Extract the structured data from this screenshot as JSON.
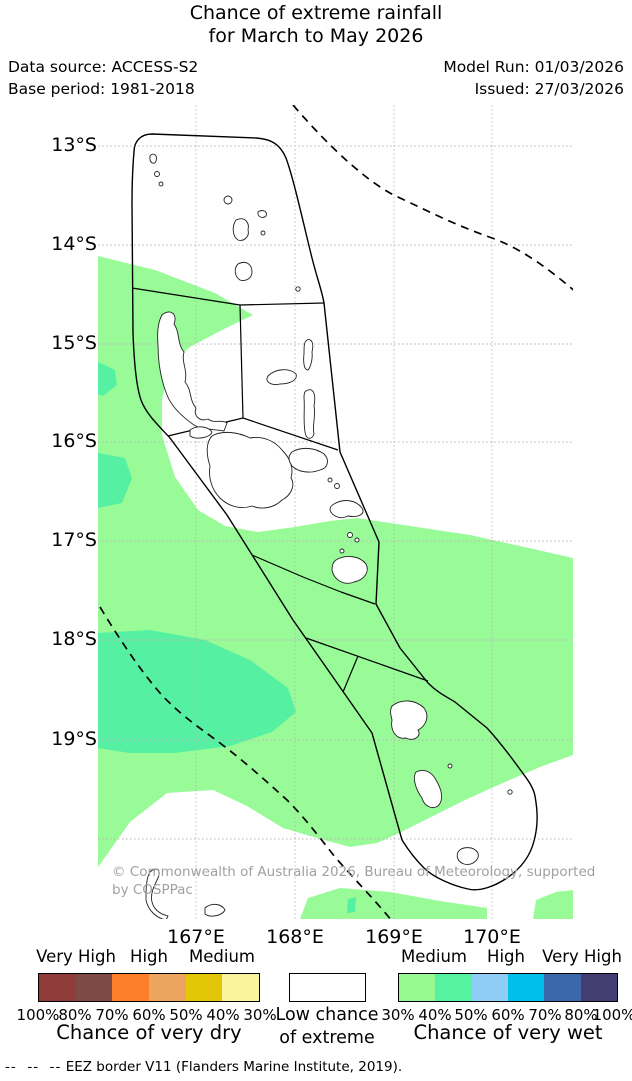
{
  "header": {
    "title_line1": "Chance of extreme rainfall",
    "title_line2": "for March to May 2026",
    "data_source": "Data source: ACCESS-S2",
    "base_period": "Base period: 1981-2018",
    "model_run": "Model Run: 01/03/2026",
    "issued": "Issued: 27/03/2026"
  },
  "map": {
    "lat_labels": [
      "13°S",
      "14°S",
      "15°S",
      "16°S",
      "17°S",
      "18°S",
      "19°S"
    ],
    "lon_labels": [
      "167°E",
      "168°E",
      "169°E",
      "170°E"
    ],
    "copyright_line1": "© Commonwealth of Australia 2026, Bureau of Meteorology, supported",
    "copyright_line2": "by COSPPac",
    "colors": {
      "wet_40_fill": "#98fb98",
      "wet_50_fill": "#55f0a2",
      "ocean_background": "#ffffff",
      "border": "#000000",
      "grid": "#b5b5b5"
    }
  },
  "legend": {
    "dry": {
      "title": "Chance of very dry",
      "levels": [
        "Very High",
        "High",
        "Medium"
      ],
      "percents": [
        "100%",
        "80%",
        "70%",
        "60%",
        "50%",
        "40%",
        "30%"
      ],
      "colors": [
        "#8f3c3b",
        "#7d4b44",
        "#fd7e2b",
        "#eca55e",
        "#e3c608",
        "#f9f59b"
      ]
    },
    "low": {
      "label_line1": "Low chance",
      "label_line2": "of extreme"
    },
    "wet": {
      "title": "Chance of very wet",
      "levels": [
        "Medium",
        "High",
        "Very High"
      ],
      "percents": [
        "30%",
        "40%",
        "50%",
        "60%",
        "70%",
        "80%",
        "100%"
      ],
      "colors": [
        "#98f993",
        "#55f2a2",
        "#8fcdf7",
        "#00bfe9",
        "#3a68a9",
        "#423e72"
      ]
    }
  },
  "footer": {
    "dash_sample": "--  --  --",
    "eez_note": " EEZ border V11 (Flanders Marine Institute, 2019)."
  }
}
